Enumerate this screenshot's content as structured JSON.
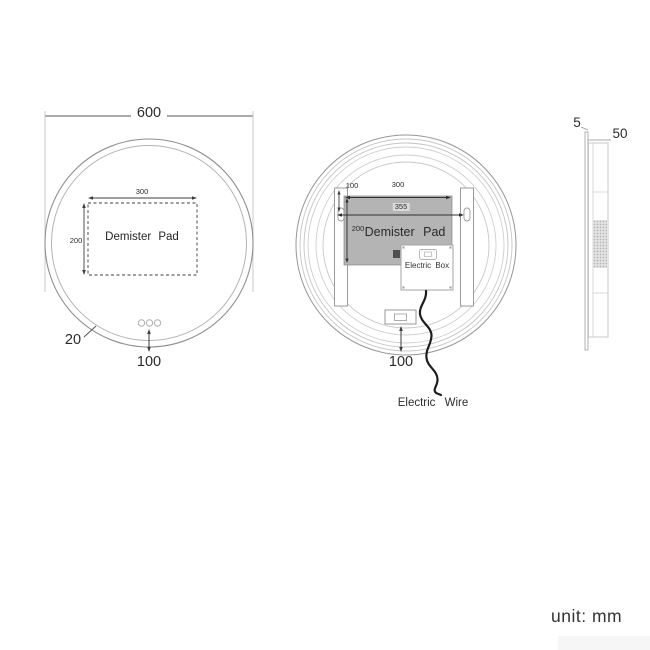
{
  "unit_note": "unit: mm",
  "colors": {
    "pad_fill": "#b4b4b4",
    "outline": "#9a9a9a",
    "dim_line": "#3d3d3d",
    "text": "#2b2b2b",
    "wire": "#1d1d1d"
  },
  "front_view": {
    "diameter_label": "600",
    "pad_width_label": "300",
    "pad_height_label": "200",
    "pad_label": "Demister Pad",
    "edge_width_label": "20",
    "sensor_offset_label": "100"
  },
  "back_view": {
    "hanger_offset_label": "100",
    "pad_width_label": "300",
    "bracket_span_label": "355",
    "pad_height_label": "200",
    "pad_label": "Demister Pad",
    "electric_box_label": "Electric Box",
    "switch_offset_label": "100",
    "wire_label": "Electric Wire"
  },
  "side_view": {
    "glass_thickness_label": "5",
    "frame_depth_label": "50"
  }
}
